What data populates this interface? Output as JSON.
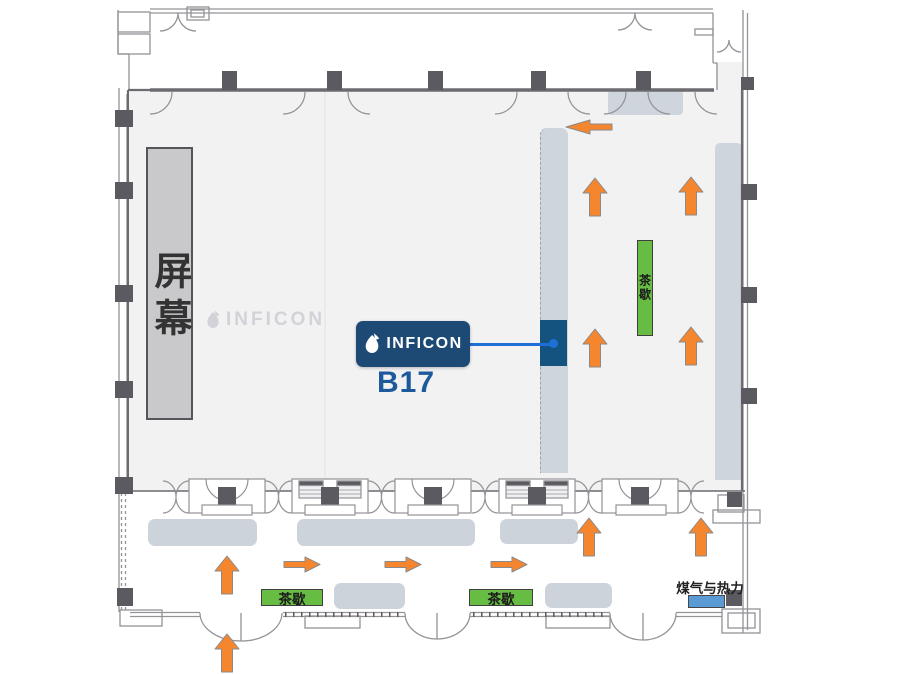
{
  "floorplan": {
    "screen_label": "屏幕",
    "watermark_brand": "INFICON",
    "booth": {
      "brand": "INFICON",
      "id": "B17"
    },
    "tea_break_stations": [
      {
        "id": "hall-right-vertical",
        "label": "茶歇",
        "orientation": "vertical"
      },
      {
        "id": "corridor-left",
        "label": "茶歇",
        "orientation": "horizontal"
      },
      {
        "id": "corridor-right",
        "label": "茶歇",
        "orientation": "horizontal"
      }
    ],
    "utility_label": "煤气与热力",
    "icons": {
      "brand_mark": "inficon-droplet",
      "flow_arrow": "orange-directional-arrow"
    },
    "arrows": [
      {
        "dir": "left",
        "x": 565,
        "y": 119
      },
      {
        "dir": "up",
        "x": 582,
        "y": 177
      },
      {
        "dir": "up",
        "x": 678,
        "y": 176
      },
      {
        "dir": "up",
        "x": 582,
        "y": 328
      },
      {
        "dir": "up",
        "x": 678,
        "y": 326
      },
      {
        "dir": "up",
        "x": 576,
        "y": 517
      },
      {
        "dir": "up",
        "x": 688,
        "y": 517
      },
      {
        "dir": "up",
        "x": 214,
        "y": 555
      },
      {
        "dir": "right",
        "x": 283,
        "y": 556
      },
      {
        "dir": "right",
        "x": 384,
        "y": 556
      },
      {
        "dir": "right",
        "x": 490,
        "y": 556
      },
      {
        "dir": "up",
        "x": 214,
        "y": 633
      }
    ],
    "colors": {
      "floor": "#f2f2f3",
      "aisle_strip": "#cfd5dc",
      "block_gray": "#cdd3db",
      "screen_fill": "#c9c9cb",
      "screen_border": "#56565a",
      "pillar": "#5a5a60",
      "wall": "#6b6b70",
      "line": "#939398",
      "arrow_orange": "#f6862e",
      "arrow_outline": "#8a8a8a",
      "tea_green": "#67bc43",
      "tea_border": "#3f3f3f",
      "brand_navy": "#1c4a74",
      "booth_navy": "#14527f",
      "link_blue": "#1e6fd6",
      "booth_text": "#1d5a9c",
      "gas_blue": "#5b9bd5",
      "watermark_gray": "#b9b9c2"
    }
  }
}
